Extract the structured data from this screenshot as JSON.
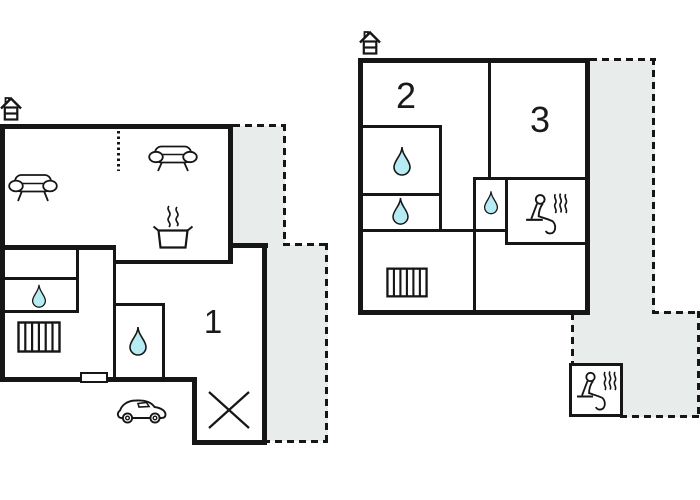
{
  "colors": {
    "wall": "#161616",
    "terrace_fill": "#e8edeb",
    "water_drop_fill": "#b6ebf3",
    "background": "#ffffff"
  },
  "ground_floor": {
    "room_labels": {
      "room1": "1"
    }
  },
  "upper_floor": {
    "room_labels": {
      "room2": "2",
      "room3": "3"
    }
  }
}
